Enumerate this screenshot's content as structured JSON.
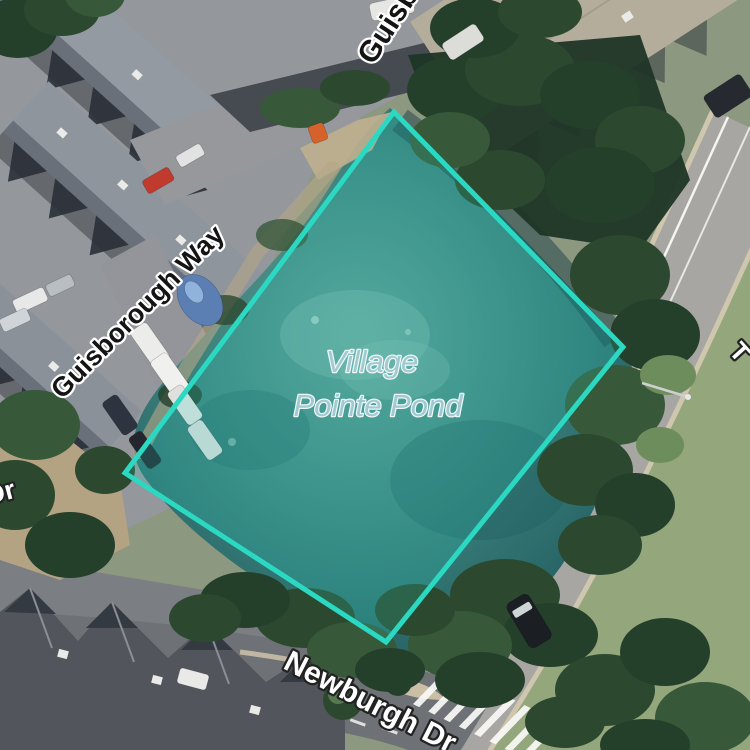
{
  "map": {
    "view": "satellite",
    "pond_label": {
      "line1": "Village",
      "line2": "Pointe Pond",
      "color": "#a2c9d3"
    },
    "street_labels": {
      "guisborough_way": "Guisborough Way",
      "guisborough_way_clipped": "Guisborough Way",
      "newburgh_dr": "Newburgh Dr",
      "dr_fragment": "Dr",
      "t_fragment": "T"
    },
    "highlight": {
      "polygon_points": "394,112 623,347 386,642 125,473",
      "stroke_color": "#2bd9c3",
      "fill_color": "rgba(44,221,199,0.18)"
    },
    "scene_colors": {
      "pond_water": "#357976",
      "road": "#a7a6a2",
      "grass": "#94a67c",
      "trees": "#2c4930",
      "roofs_nw": "#949aa2",
      "roofs_sw": "#52565c",
      "roof_ne_tan": "#b5ad9b"
    }
  }
}
